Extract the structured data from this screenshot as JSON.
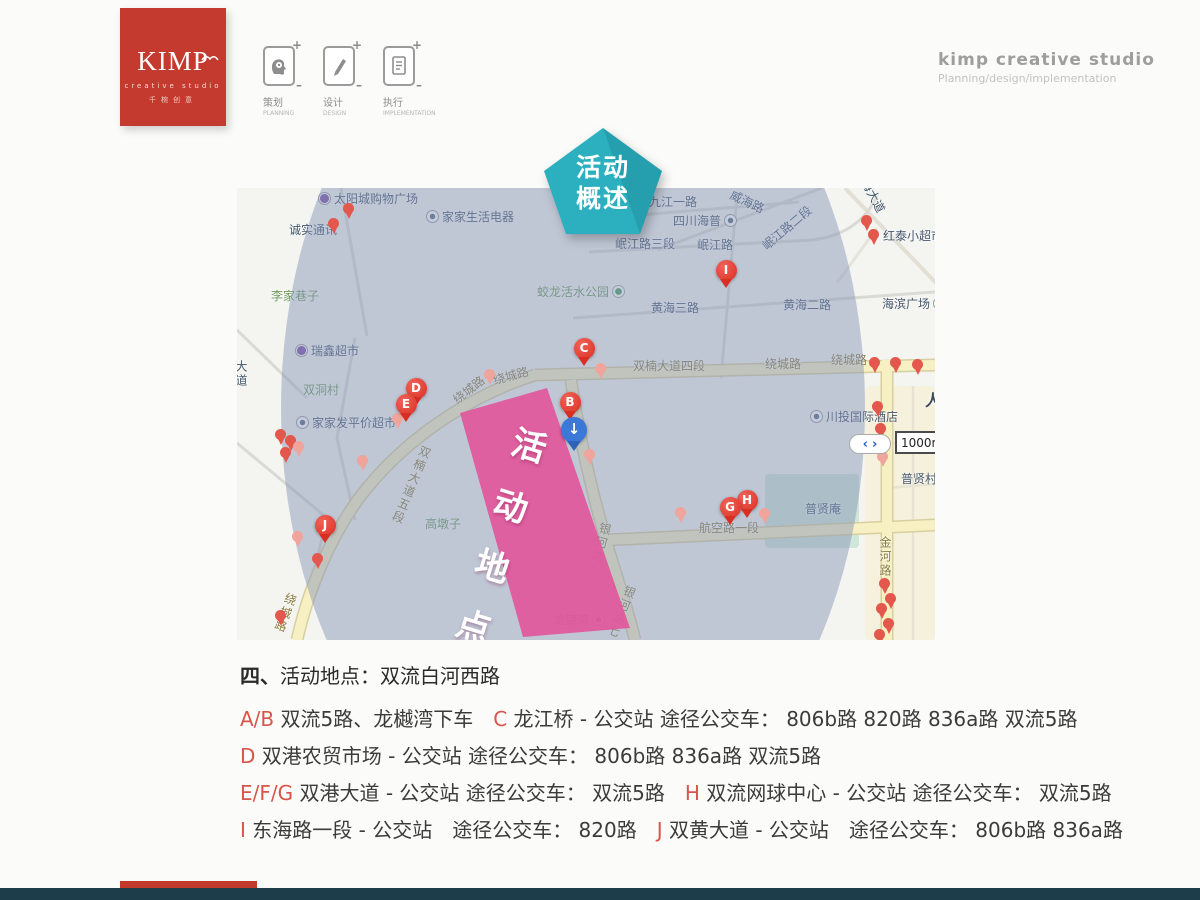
{
  "colors": {
    "accent_red": "#c53a2e",
    "badge_teal": "#2cb0bf",
    "footer_teal": "#1d3d4b",
    "footer_red": "#c13a2b",
    "event_pink": "#e1589c",
    "pin_red": "#d92f23",
    "overlay_blue": "#8594b8"
  },
  "header": {
    "logo": {
      "title": "KIMP",
      "subtitle": "creative studio",
      "tagline": "千椀创意"
    },
    "process": [
      {
        "zh": "策划",
        "en": "PLANNING"
      },
      {
        "zh": "设计",
        "en": "DESIGN"
      },
      {
        "zh": "执行",
        "en": "IMPLEMENTATION"
      }
    ],
    "studio": {
      "title": "kimp creative studio",
      "subtitle": "Planning/design/implementation"
    }
  },
  "badge": {
    "line1": "活动",
    "line2": "概述"
  },
  "map": {
    "event_area_label": "活动地点",
    "scale_control": {
      "left_arrow": "‹",
      "right_arrow": "›",
      "scale": "1000m"
    },
    "labels": [
      {
        "t": "太阳城购物广场",
        "x": 78,
        "y": 4,
        "ic": "purple",
        "ip": "l"
      },
      {
        "t": "家家生活电器",
        "x": 186,
        "y": 22,
        "ic": "ring",
        "ip": "l"
      },
      {
        "t": "诚实通讯",
        "x": 52,
        "y": 36
      },
      {
        "t": "威海路",
        "x": 492,
        "y": 8,
        "c": "p",
        "rot": 25
      },
      {
        "t": "九江一路",
        "x": 412,
        "y": 8
      },
      {
        "t": "四川海普",
        "x": 436,
        "y": 26,
        "ic": "ring",
        "ip": "r"
      },
      {
        "t": "岷江路三段",
        "x": 378,
        "y": 50
      },
      {
        "t": "岷江路",
        "x": 460,
        "y": 51
      },
      {
        "t": "岷江路二段",
        "x": 520,
        "y": 34,
        "rot": -40
      },
      {
        "t": "红泰小超市",
        "x": 646,
        "y": 42
      },
      {
        "t": "海大道",
        "x": 618,
        "y": 2,
        "rot": 62
      },
      {
        "t": "李家巷子",
        "x": 34,
        "y": 102,
        "c": "g"
      },
      {
        "t": "蛟龙活水公园",
        "x": 300,
        "y": 97,
        "c": "g",
        "ic": "green",
        "ip": "r"
      },
      {
        "t": "海滨广场",
        "x": 645,
        "y": 109,
        "ic": "ring",
        "ip": "r"
      },
      {
        "t": "黄海三路",
        "x": 414,
        "y": 114
      },
      {
        "t": "黄海二路",
        "x": 546,
        "y": 111
      },
      {
        "t": "瑞鑫超市",
        "x": 55,
        "y": 156,
        "ic": "purple",
        "ip": "l"
      },
      {
        "t": "双洞村",
        "x": 66,
        "y": 196,
        "c": "g"
      },
      {
        "t": "双楠大道四段",
        "x": 396,
        "y": 172,
        "c": "r"
      },
      {
        "t": "绕城路",
        "x": 528,
        "y": 170,
        "c": "r"
      },
      {
        "t": "绕城路",
        "x": 594,
        "y": 166,
        "c": "r"
      },
      {
        "t": "绕城路",
        "x": 214,
        "y": 196,
        "c": "r",
        "rot": -38
      },
      {
        "t": "绕城路",
        "x": 256,
        "y": 182,
        "c": "r",
        "rot": -15
      },
      {
        "t": "家家发平价超市",
        "x": 56,
        "y": 228,
        "ic": "ring",
        "ip": "l"
      },
      {
        "t": "双楠大道五段",
        "x": 168,
        "y": 255,
        "c": "r",
        "v": true,
        "rot": 22
      },
      {
        "t": "高墩子",
        "x": 188,
        "y": 330,
        "c": "g"
      },
      {
        "t": "川投国际酒店",
        "x": 570,
        "y": 222,
        "ic": "ring",
        "ip": "l"
      },
      {
        "t": "人",
        "x": 688,
        "y": 205,
        "c": "b"
      },
      {
        "t": "普贤村",
        "x": 664,
        "y": 285
      },
      {
        "t": "普贤庵",
        "x": 568,
        "y": 315
      },
      {
        "t": "航空路一段",
        "x": 462,
        "y": 334,
        "c": "r"
      },
      {
        "t": "金河路",
        "x": 642,
        "y": 348,
        "c": "r",
        "v": true
      },
      {
        "t": "银河路",
        "x": 358,
        "y": 334,
        "c": "r",
        "v": true,
        "rot": 14
      },
      {
        "t": "银河路七",
        "x": 378,
        "y": 396,
        "c": "r",
        "v": true,
        "rot": 22
      },
      {
        "t": "龙锦湾",
        "x": 316,
        "y": 425,
        "ic": "ring",
        "ip": "r"
      },
      {
        "t": "绕城路",
        "x": 42,
        "y": 404,
        "c": "r",
        "v": true,
        "rot": 20
      },
      {
        "t": "大道",
        "x": -2,
        "y": 172,
        "v": true
      }
    ],
    "markers": [
      {
        "letter": "C",
        "x": 347,
        "y": 160
      },
      {
        "letter": "I",
        "x": 489,
        "y": 82
      },
      {
        "letter": "B",
        "x": 333,
        "y": 214
      },
      {
        "letter": "D",
        "x": 179,
        "y": 200
      },
      {
        "letter": "E",
        "x": 169,
        "y": 216
      },
      {
        "letter": "J",
        "x": 88,
        "y": 337
      },
      {
        "letter": "H",
        "x": 510,
        "y": 312
      },
      {
        "letter": "G",
        "x": 493,
        "y": 319
      }
    ],
    "arrow_pin": {
      "glyph": "↓",
      "x": 337,
      "y": 242
    },
    "small_pins": [
      {
        "x": 111,
        "y": 20
      },
      {
        "x": 96,
        "y": 35
      },
      {
        "x": 629,
        "y": 32
      },
      {
        "x": 636,
        "y": 46
      },
      {
        "x": 363,
        "y": 180,
        "f": true
      },
      {
        "x": 252,
        "y": 186,
        "f": true
      },
      {
        "x": 160,
        "y": 230,
        "f": true
      },
      {
        "x": 43,
        "y": 246
      },
      {
        "x": 53,
        "y": 252
      },
      {
        "x": 61,
        "y": 258,
        "f": true
      },
      {
        "x": 48,
        "y": 264
      },
      {
        "x": 125,
        "y": 272,
        "f": true
      },
      {
        "x": 60,
        "y": 348,
        "f": true
      },
      {
        "x": 80,
        "y": 370
      },
      {
        "x": 43,
        "y": 427
      },
      {
        "x": 352,
        "y": 266,
        "f": true
      },
      {
        "x": 443,
        "y": 324,
        "f": true
      },
      {
        "x": 527,
        "y": 325,
        "f": true
      },
      {
        "x": 637,
        "y": 174
      },
      {
        "x": 658,
        "y": 174
      },
      {
        "x": 680,
        "y": 176
      },
      {
        "x": 640,
        "y": 218
      },
      {
        "x": 643,
        "y": 240
      },
      {
        "x": 645,
        "y": 268,
        "f": true
      },
      {
        "x": 647,
        "y": 395
      },
      {
        "x": 653,
        "y": 410
      },
      {
        "x": 644,
        "y": 420
      },
      {
        "x": 651,
        "y": 435
      },
      {
        "x": 642,
        "y": 446
      }
    ]
  },
  "details": {
    "heading": {
      "prefix": "四、",
      "text": "活动地点：双流白河西路"
    },
    "lines": [
      [
        {
          "t": "A/B",
          "r": 1
        },
        {
          "t": " 双流5路、龙樾湾下车　"
        },
        {
          "t": "C",
          "r": 1
        },
        {
          "t": " 龙江桥 - 公交站 途径公交车： 806b路 820路 836a路 双流5路"
        }
      ],
      [
        {
          "t": "D",
          "r": 1
        },
        {
          "t": " 双港农贸市场 - 公交站 途径公交车： 806b路 836a路 双流5路"
        }
      ],
      [
        {
          "t": "E/F/G",
          "r": 1
        },
        {
          "t": " 双港大道 - 公交站 途径公交车： 双流5路　"
        },
        {
          "t": "H",
          "r": 1
        },
        {
          "t": " 双流网球中心 - 公交站 途径公交车： 双流5路"
        }
      ],
      [
        {
          "t": "I",
          "r": 1
        },
        {
          "t": " 东海路一段 - 公交站　途径公交车： 820路　"
        },
        {
          "t": "J",
          "r": 1
        },
        {
          "t": " 双黄大道 - 公交站　途径公交车： 806b路 836a路"
        }
      ]
    ]
  }
}
